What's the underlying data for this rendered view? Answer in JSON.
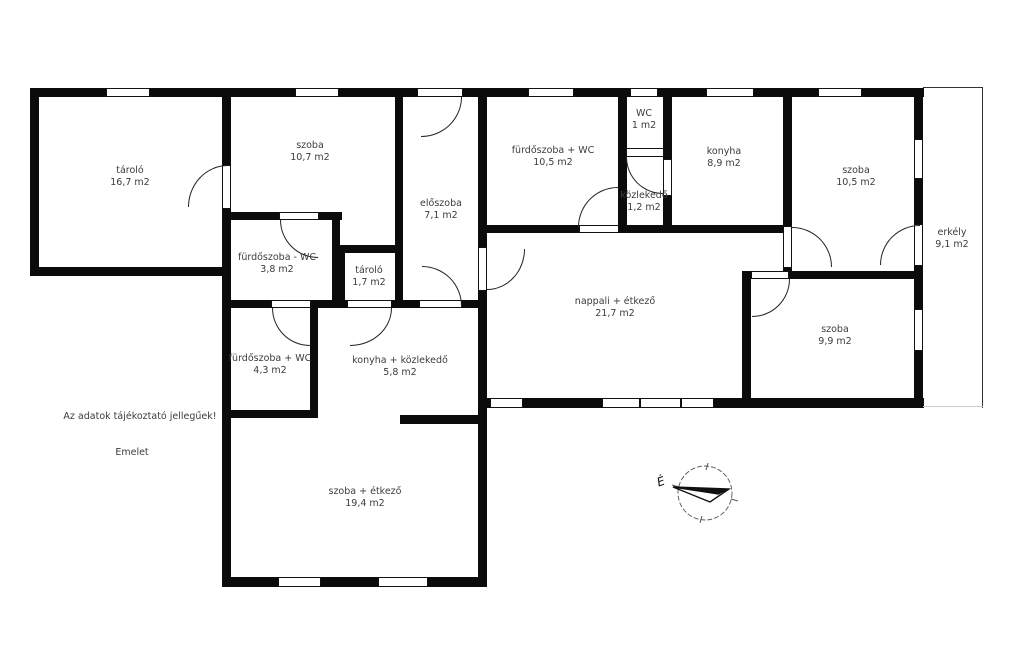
{
  "meta": {
    "disclaimer": "Az adatok tájékoztató jellegűek!",
    "floor_label": "Emelet",
    "compass_north": "É",
    "wall_color": "#0b0b0b",
    "background_color": "#ffffff"
  },
  "rooms": [
    {
      "key": "tarolo-nagy",
      "name": "tároló",
      "area": "16,7 m2"
    },
    {
      "key": "szoba-107",
      "name": "szoba",
      "area": "10,7 m2"
    },
    {
      "key": "furdoszoba-wc-38",
      "name": "fürdőszoba - WC",
      "area": "3,8 m2"
    },
    {
      "key": "tarolo-kicsi",
      "name": "tároló",
      "area": "1,7 m2"
    },
    {
      "key": "eloszoba",
      "name": "előszoba",
      "area": "7,1 m2"
    },
    {
      "key": "furdoszoba-wc-105",
      "name": "fürdőszoba + WC",
      "area": "10,5 m2"
    },
    {
      "key": "wc",
      "name": "WC",
      "area": "1 m2"
    },
    {
      "key": "kozlekedo",
      "name": "közlekedő",
      "area": "1,2 m2"
    },
    {
      "key": "konyha",
      "name": "konyha",
      "area": "8,9 m2"
    },
    {
      "key": "szoba-105",
      "name": "szoba",
      "area": "10,5 m2"
    },
    {
      "key": "erkely",
      "name": "erkély",
      "area": "9,1 m2"
    },
    {
      "key": "nappali-etkezo",
      "name": "nappali + étkező",
      "area": "21,7 m2"
    },
    {
      "key": "szoba-99",
      "name": "szoba",
      "area": "9,9 m2"
    },
    {
      "key": "furdoszoba-wc-43",
      "name": "fürdőszoba + WC",
      "area": "4,3 m2"
    },
    {
      "key": "konyha-kozlekedo",
      "name": "konyha + közlekedő",
      "area": "5,8 m2"
    },
    {
      "key": "szoba-etkezo",
      "name": "szoba + étkező",
      "area": "19,4 m2"
    }
  ]
}
